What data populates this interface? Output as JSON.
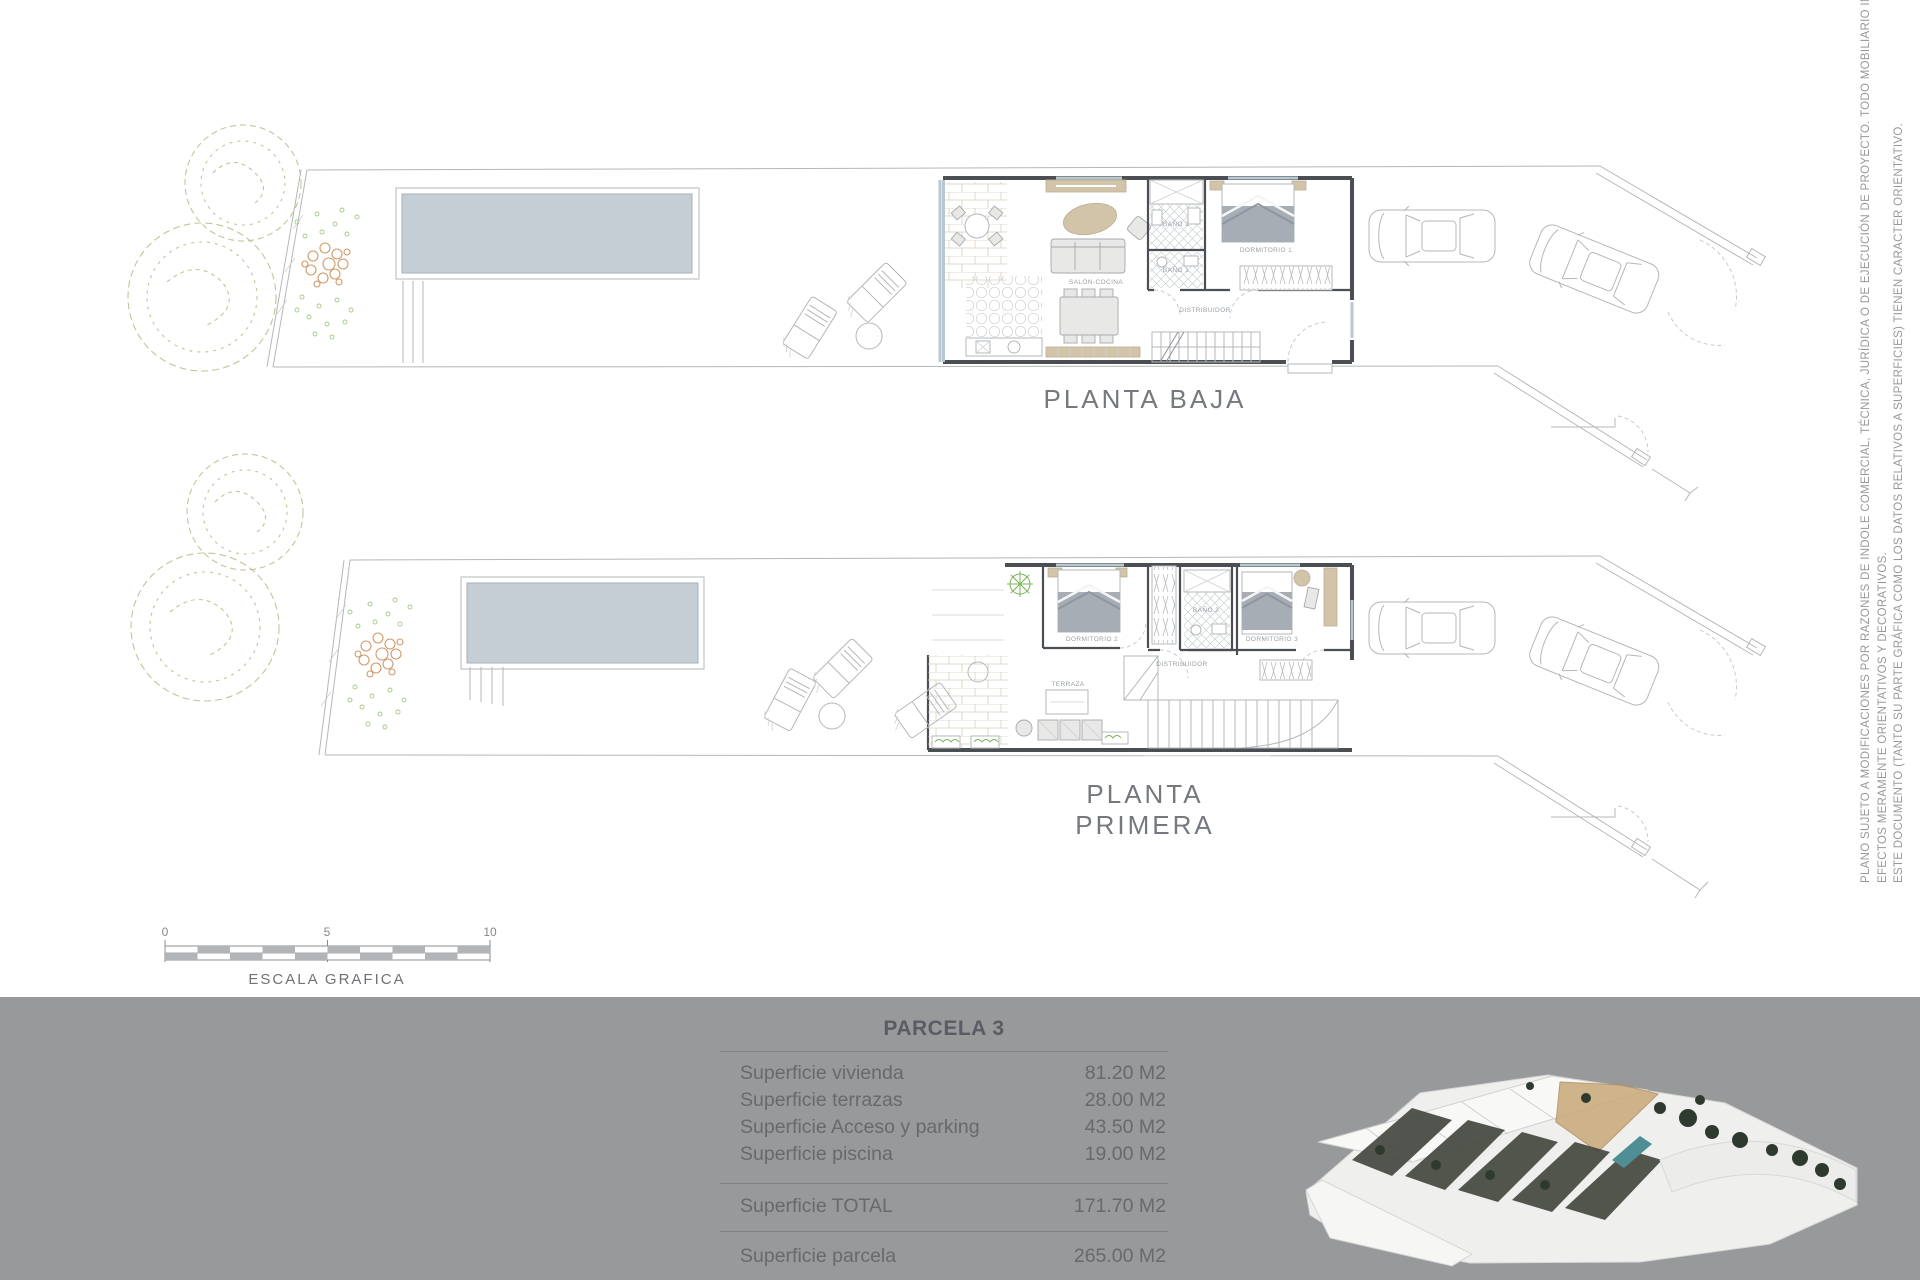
{
  "plans": {
    "baja": {
      "title": "PLANTA BAJA",
      "rooms": {
        "salon": "SALÓN-COCINA",
        "bano2": "BAÑO 2",
        "bano1": "BAÑO 1",
        "dormitorio": "DORMITORIO 1",
        "distribuidor": "DISTRIBUIDOR"
      }
    },
    "primera": {
      "title": "PLANTA PRIMERA",
      "rooms": {
        "dormitorio2": "DORMITORIO 2",
        "dormitorio3": "DORMITORIO 3",
        "bano": "BAÑO 3",
        "terraza": "TERRAZA",
        "distribuidor": "DISTRIBUIDOR"
      }
    }
  },
  "scale": {
    "label": "ESCALA GRAFICA",
    "start": "0",
    "mid": "5",
    "end": "10"
  },
  "summary": {
    "title": "PARCELA 3",
    "rows": [
      {
        "label": "Superficie vivienda",
        "value": "81.20 M2"
      },
      {
        "label": "Superficie terrazas",
        "value": "28.00 M2"
      },
      {
        "label": "Superficie Acceso y parking",
        "value": "43.50 M2"
      },
      {
        "label": "Superficie piscina",
        "value": "19.00 M2"
      }
    ],
    "total": {
      "label": "Superficie TOTAL",
      "value": "171.70 M2"
    },
    "parcela": {
      "label": "Superficie parcela",
      "value": "265.00 M2"
    }
  },
  "disclaimer": {
    "line1": "PLANO SUJETO A MODIFICACIONES POR RAZONES DE INDOLE COMERCIAL, TÉCNICA, JURÍDICA O DE EJECUCIÓN DE PROYECTO. TODO MOBILIARIO INCLUIDO SE HA REPRESENTADO A",
    "line2": "EFECTOS MERAMENTE ORIENTATIVOS Y DECORATIVOS.",
    "line3": "ESTE DOCUMENTO (TANTO SU PARTE GRÁFICA COMO LOS DATOS RELATIVOS A SUPERFICIES) TIENEN CARACTER ORIENTATIVO."
  },
  "colors": {
    "footer_bg": "#98999b",
    "pool": "#c5ced5",
    "wall": "#4b4f54",
    "tan": "#d2c4a9",
    "text": "#686b6f"
  }
}
